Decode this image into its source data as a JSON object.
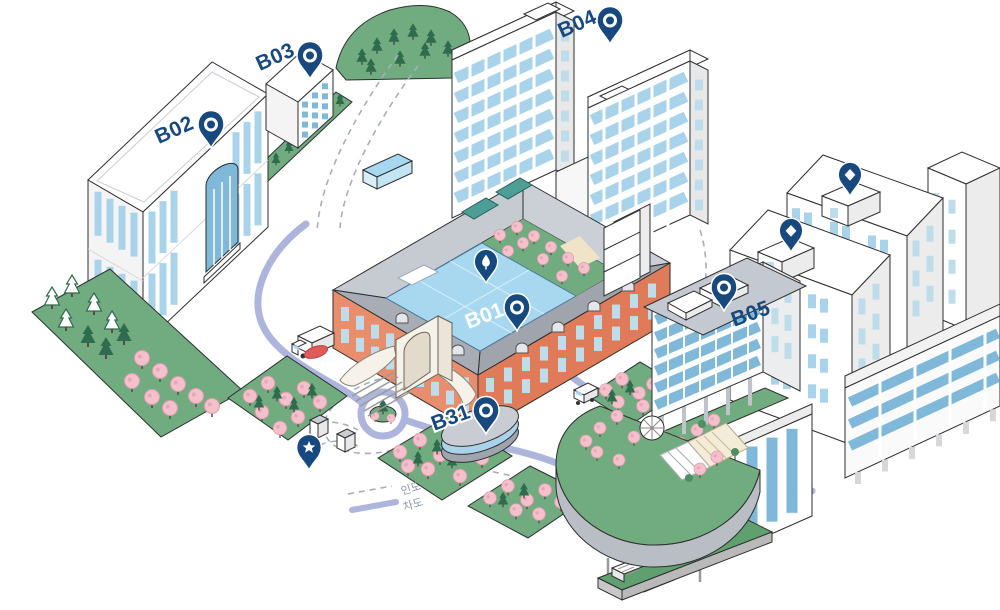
{
  "map": {
    "buildings": [
      {
        "id": "b01",
        "label": "B01",
        "pin": "ring"
      },
      {
        "id": "b02",
        "label": "B02",
        "pin": "ring"
      },
      {
        "id": "b03",
        "label": "B03",
        "pin": "ring"
      },
      {
        "id": "b04",
        "label": "B04",
        "pin": "ring"
      },
      {
        "id": "b05",
        "label": "B05",
        "pin": "ring"
      },
      {
        "id": "b31",
        "label": "B31",
        "pin": "ring"
      }
    ],
    "unlabeled_pins": [
      {
        "id": "pin-diamond-tower-front",
        "icon": "diamond"
      },
      {
        "id": "pin-diamond-tower-back",
        "icon": "diamond"
      },
      {
        "id": "pin-star-plaza",
        "icon": "star"
      },
      {
        "id": "pin-tree-courtyard",
        "icon": "tree"
      }
    ],
    "legend": {
      "items": [
        {
          "id": "sidewalk",
          "label": "인도",
          "line_style": "dashed"
        },
        {
          "id": "roadway",
          "label": "차도",
          "line_style": "solid"
        }
      ]
    },
    "colors": {
      "pin": "#17497E",
      "label": "#17497E",
      "road": "#ADB5DC",
      "path_dash": "#A9AEB6",
      "window": "#A9D3EA",
      "window_deep": "#7FB8D8",
      "glass_roof": "#A7D8F0",
      "brick": "#E98E6D",
      "brick_shade": "#DF7B58",
      "roof_gray": "#A7ACB5",
      "green": "#71AC80",
      "green_dark": "#2F6B4D",
      "blossom": "#F3C0CC",
      "beige": "#EFE3C8",
      "red_marker": "#E05A5A"
    }
  }
}
